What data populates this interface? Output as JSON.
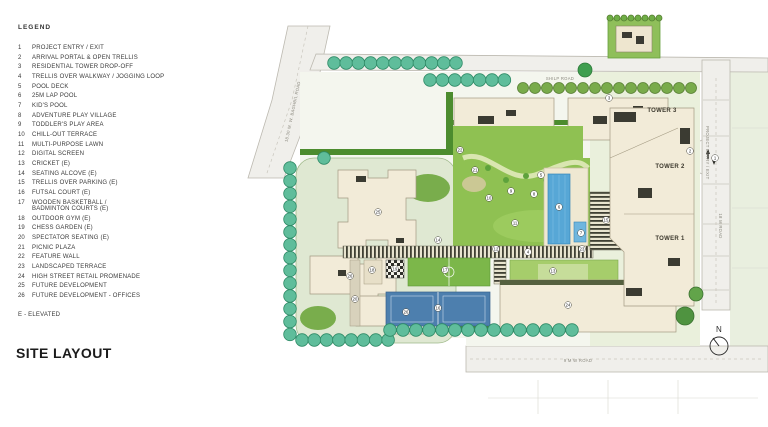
{
  "legend": {
    "title": "LEGEND",
    "items": [
      {
        "num": "1",
        "label": "PROJECT ENTRY / EXIT"
      },
      {
        "num": "2",
        "label": "ARRIVAL PORTAL & OPEN TRELLIS"
      },
      {
        "num": "3",
        "label": "RESIDENTIAL TOWER DROP-OFF"
      },
      {
        "num": "4",
        "label": "TRELLIS OVER WALKWAY / JOGGING LOOP"
      },
      {
        "num": "5",
        "label": "POOL DECK"
      },
      {
        "num": "6",
        "label": "25M LAP POOL"
      },
      {
        "num": "7",
        "label": "KID'S POOL"
      },
      {
        "num": "8",
        "label": "ADVENTURE PLAY VILLAGE"
      },
      {
        "num": "9",
        "label": "TODDLER'S PLAY AREA"
      },
      {
        "num": "10",
        "label": "CHILL-OUT TERRACE"
      },
      {
        "num": "11",
        "label": "MULTI-PURPOSE LAWN"
      },
      {
        "num": "12",
        "label": "DIGITAL SCREEN"
      },
      {
        "num": "13",
        "label": "CRICKET (E)"
      },
      {
        "num": "14",
        "label": "SEATING ALCOVE (E)"
      },
      {
        "num": "15",
        "label": "TRELLIS OVER PARKING (E)"
      },
      {
        "num": "16",
        "label": "FUTSAL COURT (E)"
      },
      {
        "num": "17",
        "label": "WOODEN BASKETBALL /\nBADMINTON COURTS (E)"
      },
      {
        "num": "18",
        "label": "OUTDOOR GYM (E)"
      },
      {
        "num": "19",
        "label": "CHESS GARDEN (E)"
      },
      {
        "num": "20",
        "label": "SPECTATOR SEATING (E)"
      },
      {
        "num": "21",
        "label": "PICNIC PLAZA"
      },
      {
        "num": "22",
        "label": "FEATURE WALL"
      },
      {
        "num": "23",
        "label": "LANDSCAPED TERRACE"
      },
      {
        "num": "24",
        "label": "HIGH STREET RETAIL PROMENADE"
      },
      {
        "num": "25",
        "label": "FUTURE DEVELOPMENT"
      },
      {
        "num": "26",
        "label": "FUTURE DEVELOPMENT - OFFICES"
      }
    ],
    "note": "E - ELEVATED"
  },
  "page": {
    "title": "SITE LAYOUT"
  },
  "map": {
    "roads": {
      "top": "SHILP ROAD",
      "left": "18.30 M. W. BAGHBIL ROAD",
      "right": "18 M ROAD",
      "bottom": "9 M W ROAD",
      "entry": "PROJECT ENTRY / EXIT"
    },
    "towers": [
      {
        "label": "TOWER 3"
      },
      {
        "label": "TOWER 2"
      },
      {
        "label": "TOWER 1"
      }
    ],
    "compass": {
      "label": "N"
    },
    "markers": [
      {
        "n": "1",
        "x": 477,
        "y": 150
      },
      {
        "n": "2",
        "x": 452,
        "y": 143
      },
      {
        "n": "3",
        "x": 371,
        "y": 90
      },
      {
        "n": "4",
        "x": 290,
        "y": 244
      },
      {
        "n": "5",
        "x": 303,
        "y": 167
      },
      {
        "n": "6",
        "x": 321,
        "y": 199
      },
      {
        "n": "7",
        "x": 343,
        "y": 225
      },
      {
        "n": "8",
        "x": 296,
        "y": 186
      },
      {
        "n": "9",
        "x": 273,
        "y": 183
      },
      {
        "n": "10",
        "x": 251,
        "y": 190
      },
      {
        "n": "11",
        "x": 277,
        "y": 215
      },
      {
        "n": "12",
        "x": 258,
        "y": 241
      },
      {
        "n": "13",
        "x": 315,
        "y": 263
      },
      {
        "n": "14",
        "x": 200,
        "y": 232
      },
      {
        "n": "15",
        "x": 368,
        "y": 212
      },
      {
        "n": "16",
        "x": 200,
        "y": 300
      },
      {
        "n": "17",
        "x": 207,
        "y": 262
      },
      {
        "n": "18",
        "x": 134,
        "y": 262
      },
      {
        "n": "19",
        "x": 157,
        "y": 261
      },
      {
        "n": "20",
        "x": 117,
        "y": 291
      },
      {
        "n": "21",
        "x": 237,
        "y": 162
      },
      {
        "n": "22",
        "x": 222,
        "y": 142
      },
      {
        "n": "23",
        "x": 344,
        "y": 241
      },
      {
        "n": "24",
        "x": 330,
        "y": 297
      },
      {
        "n": "25",
        "x": 140,
        "y": 204
      },
      {
        "n": "26",
        "x": 112,
        "y": 268
      },
      {
        "n": "26",
        "x": 168,
        "y": 304
      }
    ]
  },
  "colors": {
    "tree_teal": "#5fbd9b",
    "tree_teal_stroke": "#2e8a66",
    "tree_olive": "#79ab4b",
    "tree_olive_stroke": "#587f34",
    "lawn": "#8fc152",
    "hedge": "#4c8c2e",
    "pool": "#57a7d6",
    "court_blue": "#4d7fae",
    "court_green": "#7cb74a",
    "building": "#f2ebd8",
    "road": "#f0efeb"
  }
}
